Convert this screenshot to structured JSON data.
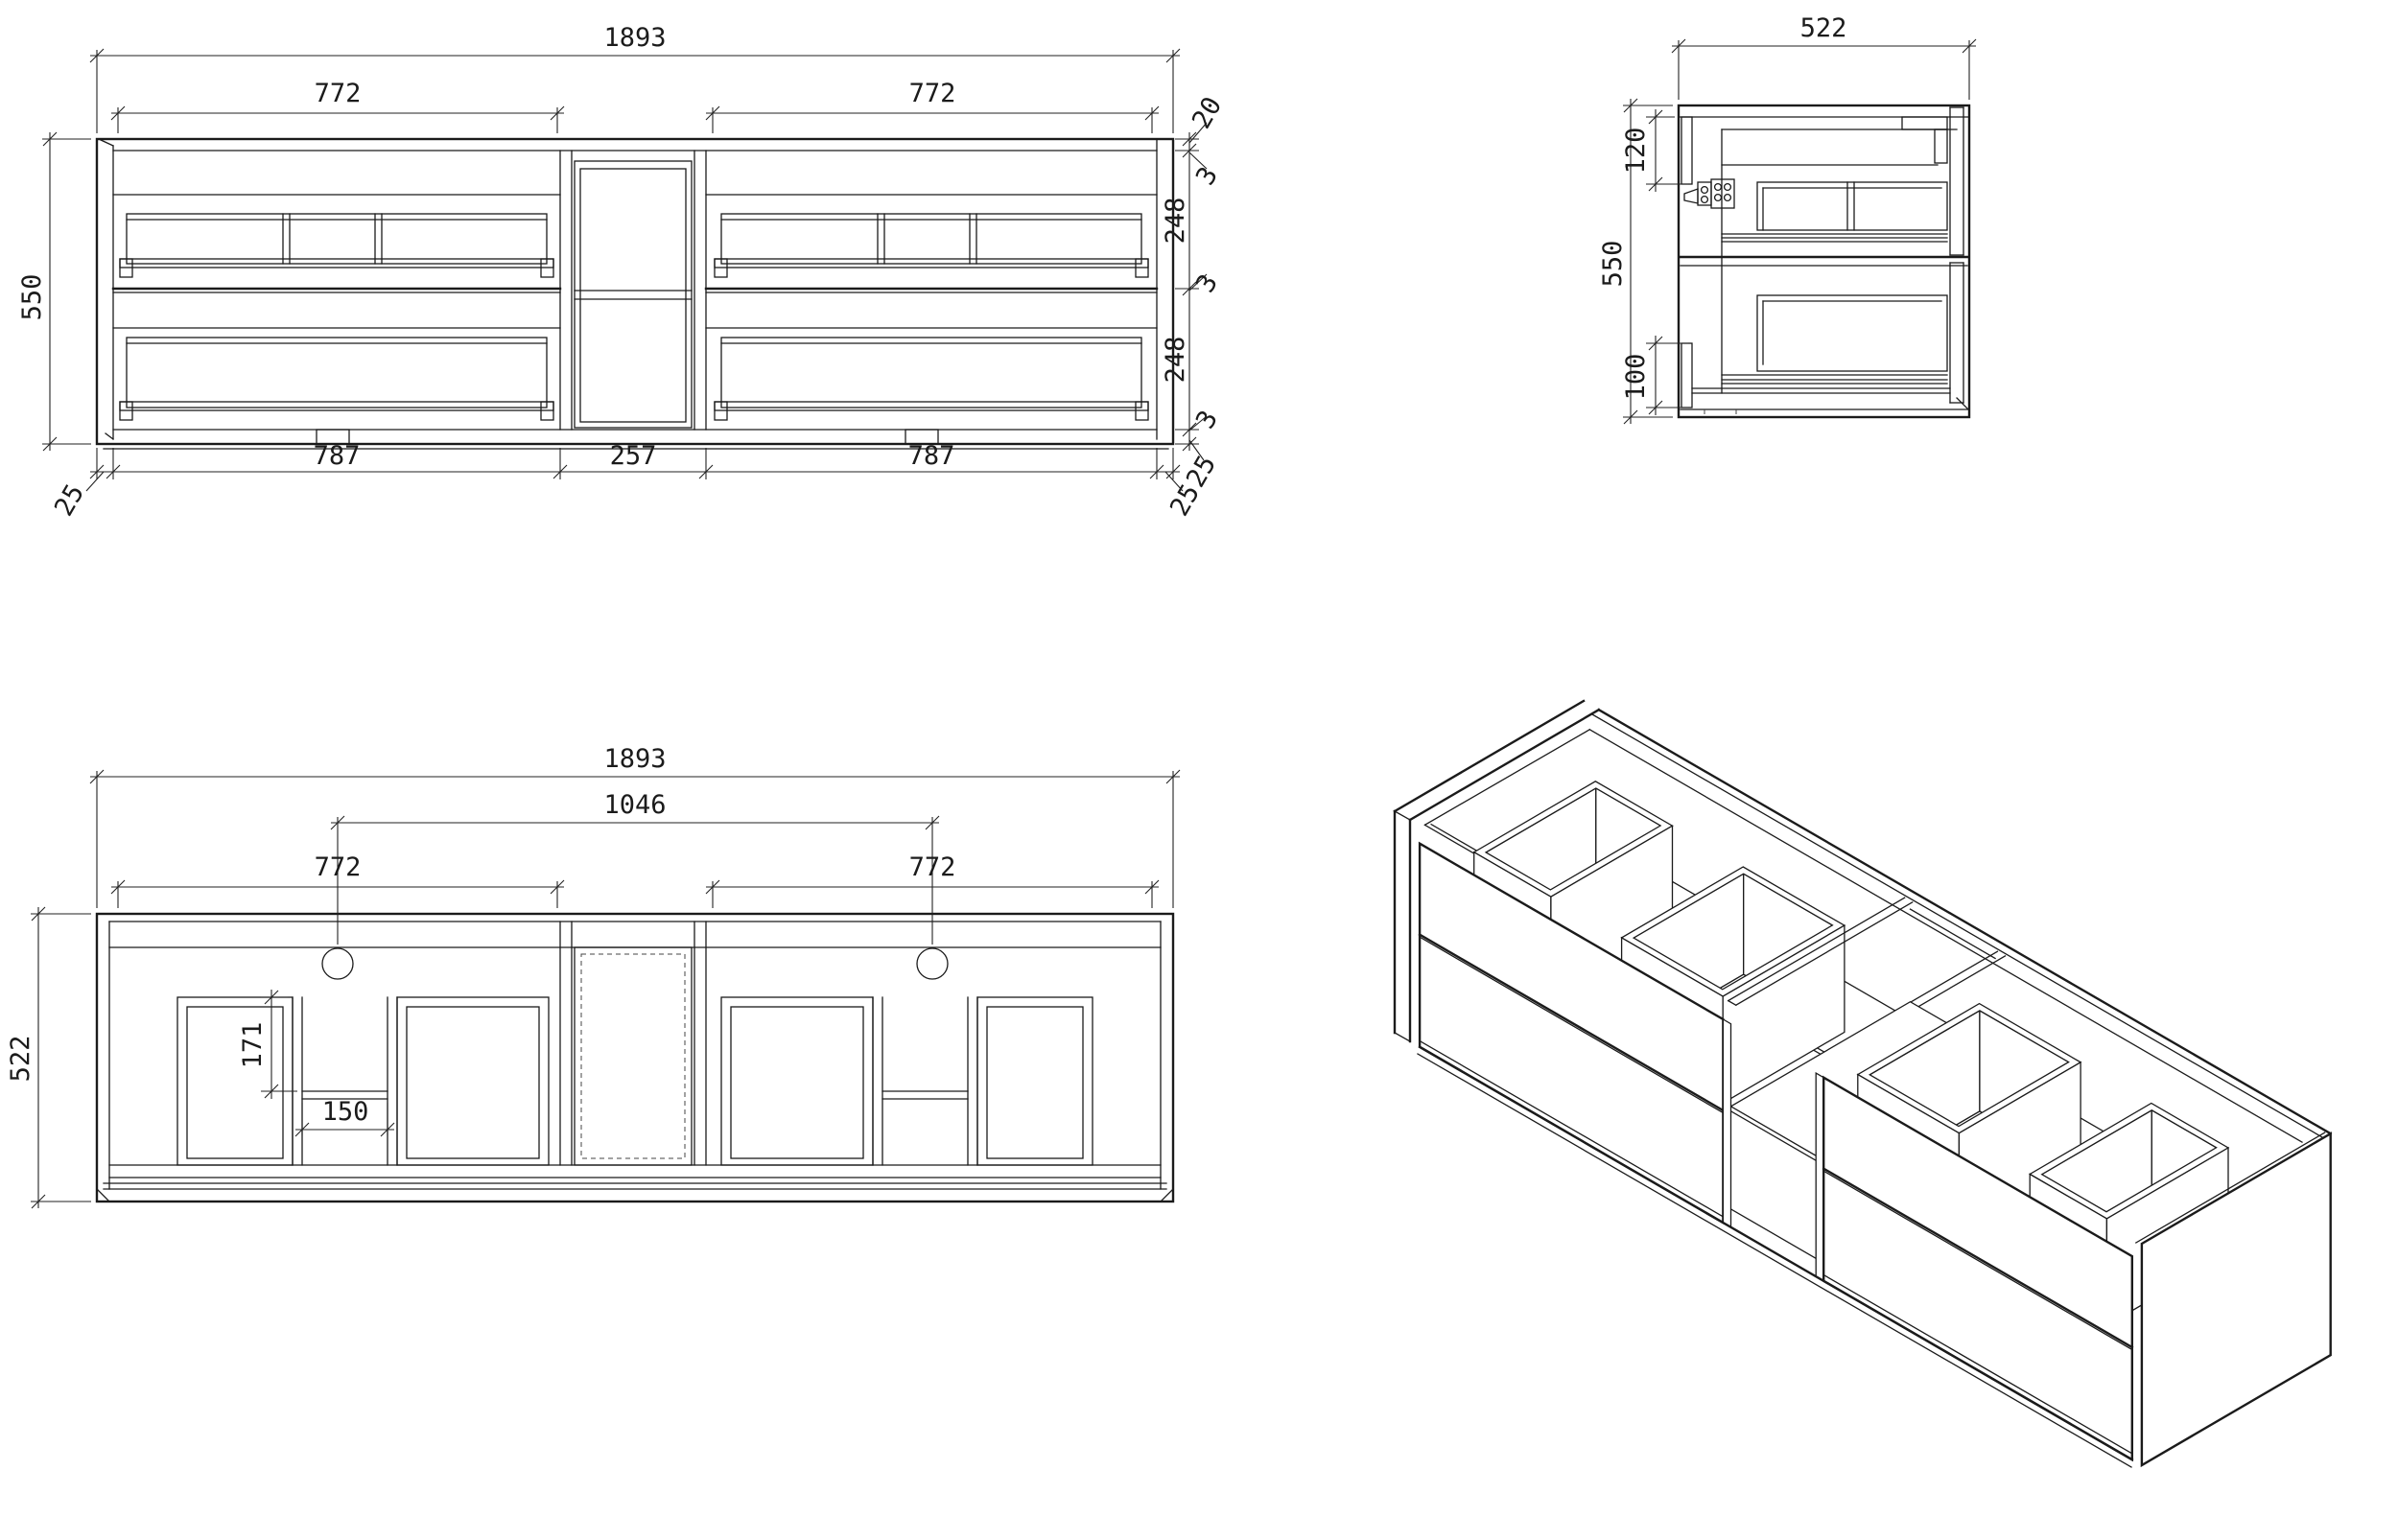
{
  "drawing": {
    "type": "cabinet-technical-drawing",
    "line_color": "#1b1b1b",
    "background": "#ffffff"
  },
  "front_view": {
    "total_width": "1893",
    "left_drawer_width": "772",
    "right_drawer_width": "772",
    "height": "550",
    "top_panel": "20",
    "gap_top": "3",
    "upper_drawer": "248",
    "gap_mid": "3",
    "lower_drawer": "248",
    "gap_bottom": "3",
    "plinth": "25",
    "bottom_left_panel": "25",
    "bottom_left_section": "787",
    "bottom_mid_section": "257",
    "bottom_right_section": "787",
    "bottom_right_panel": "25"
  },
  "side_view": {
    "depth": "522",
    "height": "550",
    "top_rail_offset": "120",
    "bottom_rail_offset": "100"
  },
  "plan_view": {
    "total_width": "1893",
    "faucet_span": "1046",
    "left_drawer_width": "772",
    "right_drawer_width": "772",
    "depth": "522",
    "cutout_depth": "171",
    "cutout_width": "150"
  }
}
